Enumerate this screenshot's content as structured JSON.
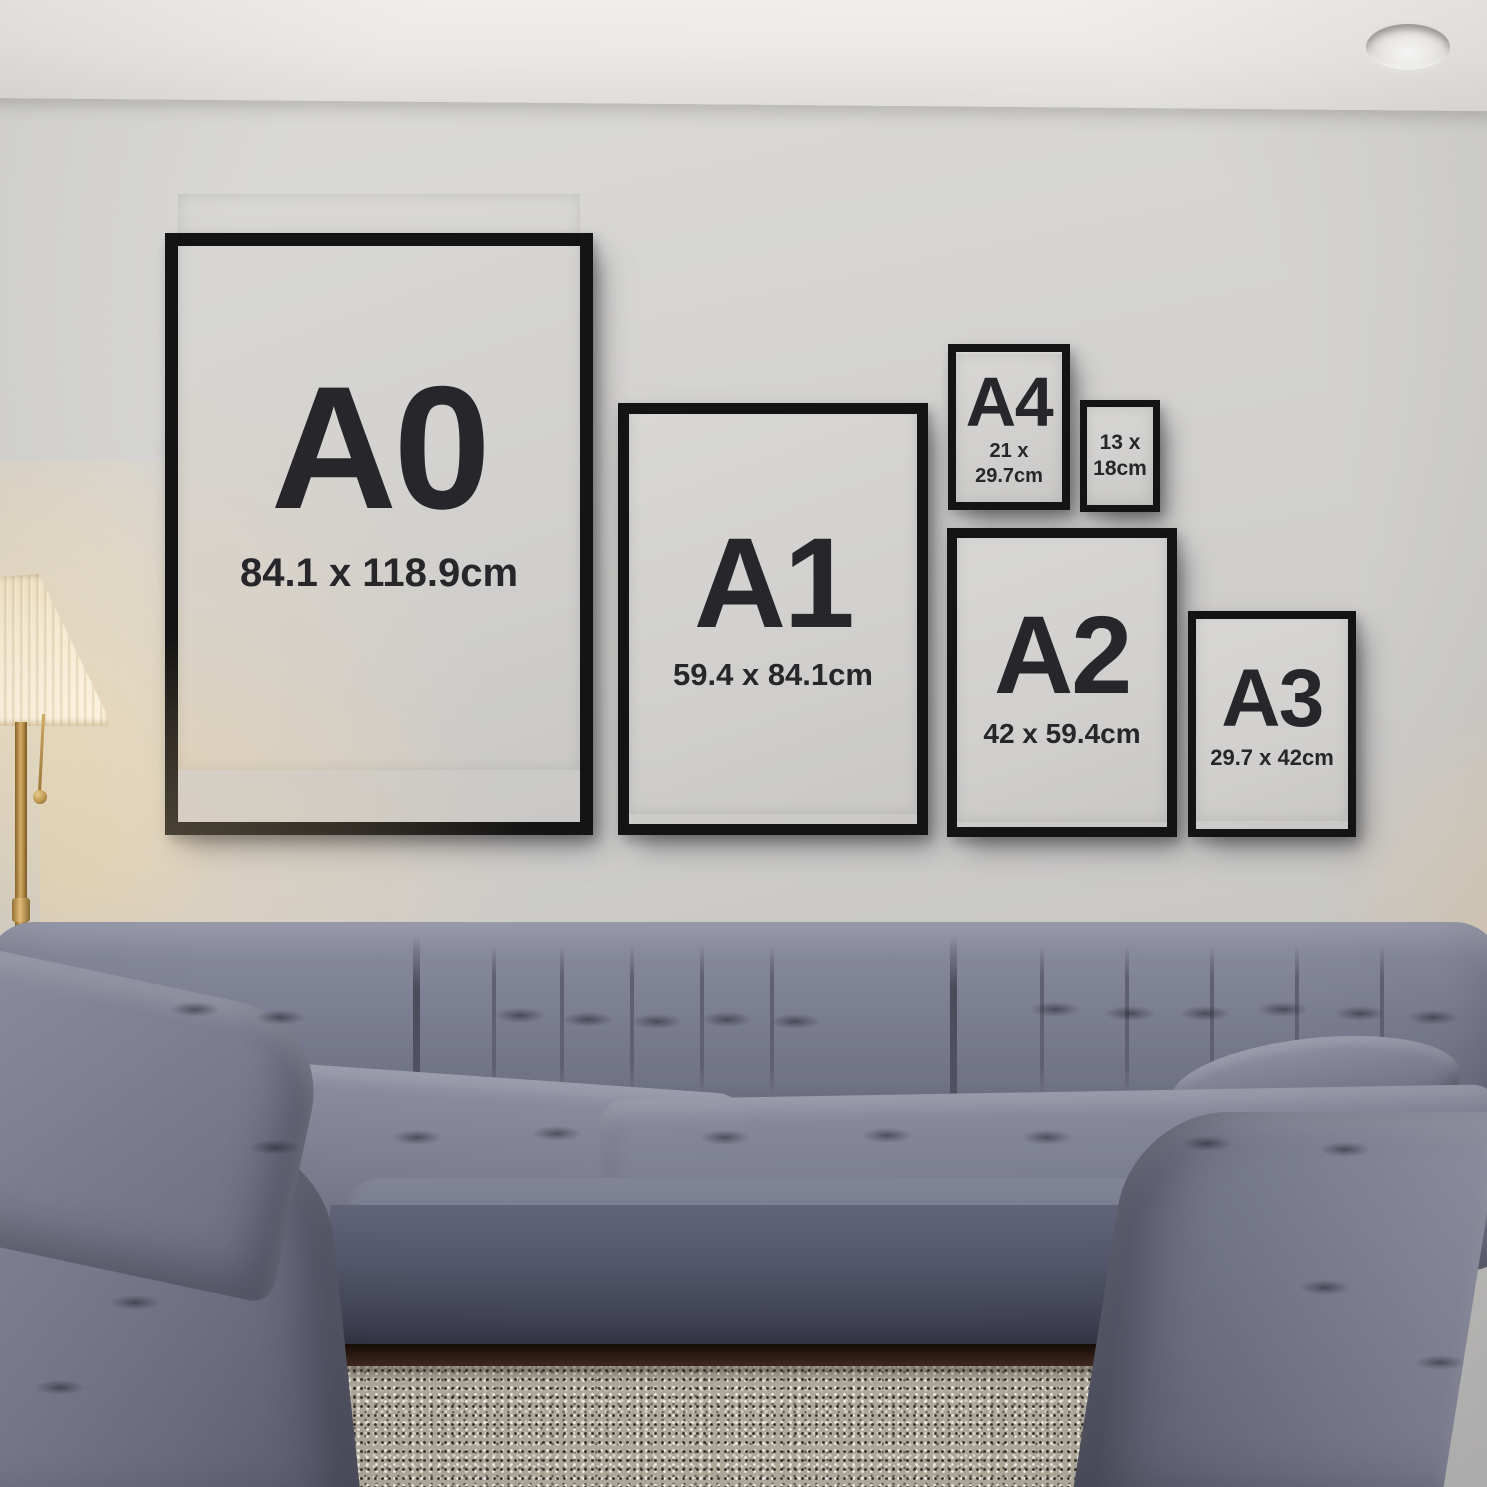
{
  "frames": [
    {
      "label": "A0",
      "dimensions": "84.1 x 118.9cm"
    },
    {
      "label": "A1",
      "dimensions": "59.4 x 84.1cm"
    },
    {
      "label": "A4",
      "dimensions": "21 x 29.7cm"
    },
    {
      "label": "",
      "dimensions": "13 x\n18cm"
    },
    {
      "label": "A2",
      "dimensions": "42 x 59.4cm"
    },
    {
      "label": "A3",
      "dimensions": "29.7 x 42cm"
    }
  ],
  "colors": {
    "frame_black": "#141414",
    "poster_gray": "#d1d0ce",
    "text_dark": "#27262a",
    "wall_gray": "#cecdcb",
    "ceiling_white": "#ebe9e5",
    "sofa_gray_blue": "#74768a",
    "rug_beige": "#b2aa9c",
    "floor_brown": "#3b241a",
    "lamp_shade_cream": "#f7edd5",
    "lamp_brass": "#c29a50"
  }
}
